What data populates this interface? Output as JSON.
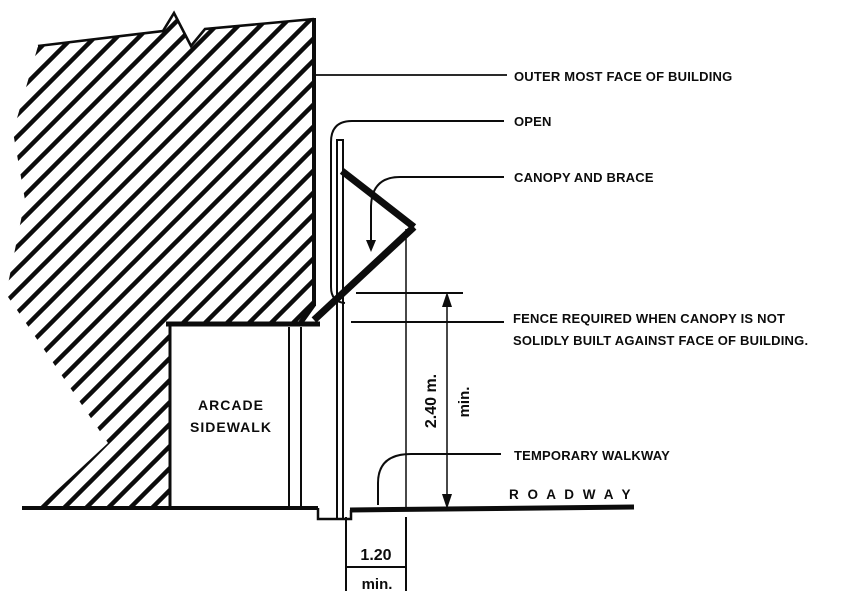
{
  "diagram": {
    "callouts": {
      "outer_face": "OUTER MOST FACE OF BUILDING",
      "open": "OPEN",
      "canopy_brace": "CANOPY AND BRACE",
      "fence_line1": "FENCE REQUIRED WHEN CANOPY IS NOT",
      "fence_line2": "SOLIDLY BUILT AGAINST FACE OF BUILDING.",
      "temporary_walkway": "TEMPORARY WALKWAY",
      "roadway": "R O A D W A Y"
    },
    "areas": {
      "arcade_line1": "ARCADE",
      "arcade_line2": "SIDEWALK"
    },
    "dimensions": {
      "height_value": "2.40 m.",
      "height_qualifier": "min.",
      "width_value": "1.20",
      "width_qualifier": "min."
    },
    "colors": {
      "ink": "#0c0c0c",
      "paper": "#ffffff"
    }
  }
}
